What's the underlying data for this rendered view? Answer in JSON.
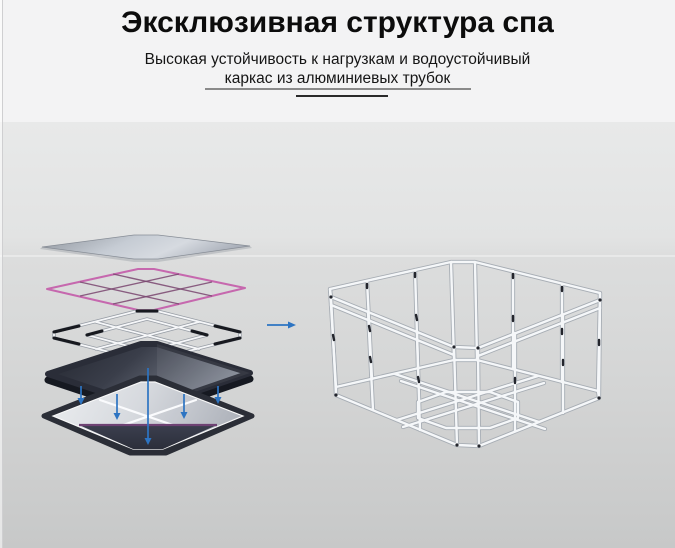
{
  "header": {
    "title": "Эксклюзивная структура спа",
    "subtitle_line1": "Высокая устойчивость к нагрузкам и водоустойчивый",
    "subtitle_line2": "каркас из алюминиевых трубок"
  },
  "scene": {
    "left_object": "exploded-layer-stack",
    "left_layers": [
      "top-cover-layer",
      "pink-grid-liner-layer",
      "tube-grid-layer",
      "dark-base-mat-layer",
      "bottom-pad-layer"
    ],
    "right_object": "aluminum-tube-frame",
    "icons": [
      "right-arrow-icon",
      "down-arrow-icon",
      "down-arrow-icon",
      "down-arrow-icon",
      "down-arrow-icon",
      "down-arrow-icon"
    ]
  },
  "colors": {
    "accent_blue": "#2d74c2",
    "accent_pink": "#c668ae",
    "accent_purple": "#6e4273",
    "underline_gray": "#8a8a8a",
    "underline_dark": "#2a2a2a",
    "title_text": "#0c0c0c",
    "header_bg": "#f3f3f4",
    "backdrop_top": "#e8e9e9",
    "backdrop_bottom": "#c7c8c8",
    "dark_layer": "#2a2d38",
    "silver_layer": "#c6ccd4"
  }
}
